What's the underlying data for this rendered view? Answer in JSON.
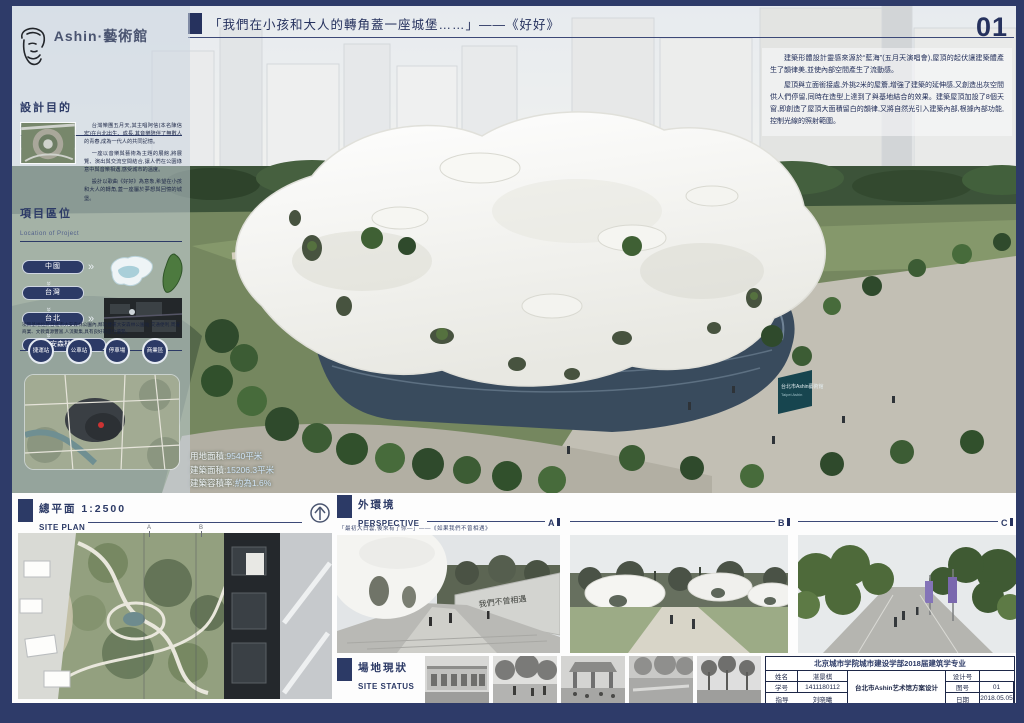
{
  "page": {
    "number": "01"
  },
  "header": {
    "quote": "「我們在小孩和大人的轉角蓋一座城堡……」——《好好》"
  },
  "intro": {
    "para1": "建築形體設計靈感來源於“藍海”(五月天演唱會),屋頂的起伏讓建築體產生了韻律美,並使內部空間產生了流動感。",
    "para2": "屋頂與立面銜接處,外挑2米的屋簷,增強了建築的延伸感,又創造出灰空間供人們停留,同時在造型上達到了與基地結合的效果。建築屋頂加設了8個天窗,即創造了屋頂大面積留白的韻律,又將自然光引入建築內部,根據內部功能,控制光線的照射範圍。"
  },
  "sidebar": {
    "brand": "Ashin·藝術館",
    "aim": {
      "title": "設計目的",
      "subtitle": "Aim of Design",
      "paragraphs": [
        "台灣樂團五月天,其主唱阿信(本名陳信宏)在台北出生、成長,其音樂陪伴了無數人的青春,成為一代人的共同記憶。",
        "一座以音樂與藝術為主題的展館,將展覽、演出與交流空間結合,讓人們在公園綠意中與音樂相遇,感受城市的溫度。",
        "設計以歌曲《好好》為意象,希望在小孩和大人的轉角,蓋一座屬於夢想與回憶的城堡。"
      ]
    },
    "location": {
      "title": "項目區位",
      "subtitle": "Location of Project",
      "buttons": [
        "中國",
        "台灣",
        "台北",
        "大安森林公園"
      ],
      "note": "項目基地位於台北市大安森林公園內,鄰近捷運大安森林公園站,交通便利,周邊商業、文教資源豐富,人流聚集,具有良好的區位優勢。",
      "nodes": [
        "捷運站",
        "公車站",
        "停車場",
        "商業區"
      ]
    }
  },
  "render": {
    "sign_line1": "台北市Ashin藝術館",
    "sign_line2": "Taipei Ashin",
    "stats": [
      {
        "label": "用地面積:",
        "value": "9540平米"
      },
      {
        "label": "建築面積:",
        "value": "15206.3平米"
      },
      {
        "label": "建築容積率:",
        "value": "約為1.6%"
      }
    ]
  },
  "site_plan": {
    "title": "總平面 1:2500",
    "subtitle": "SITE PLAN",
    "marker_a": "A",
    "marker_b": "B"
  },
  "perspective": {
    "title": "外環境",
    "subtitle": "PERSPECTIVE",
    "quote": "「最初大白雲,後來有了你—」——《如果我們不曾相遇》",
    "labels": [
      "A",
      "B",
      "C"
    ],
    "wall_text": "我們不曾相遇"
  },
  "site_status": {
    "title": "場地現狀",
    "subtitle": "SITE STATUS"
  },
  "title_block": {
    "school": "北京城市学院城市建设学部2018届建筑学专业",
    "name_label": "姓名",
    "name": "湛景棋",
    "sid_label": "学号",
    "sid": "1411180112",
    "advisor_label": "指导",
    "advisor": "刘晓曦",
    "project": "台北市Ashin艺术馆方案设计",
    "design_label": "设计号",
    "design_no": "",
    "sheet_label": "图号",
    "sheet_no": "01",
    "date_label": "日期",
    "date": "2018.05.05"
  }
}
